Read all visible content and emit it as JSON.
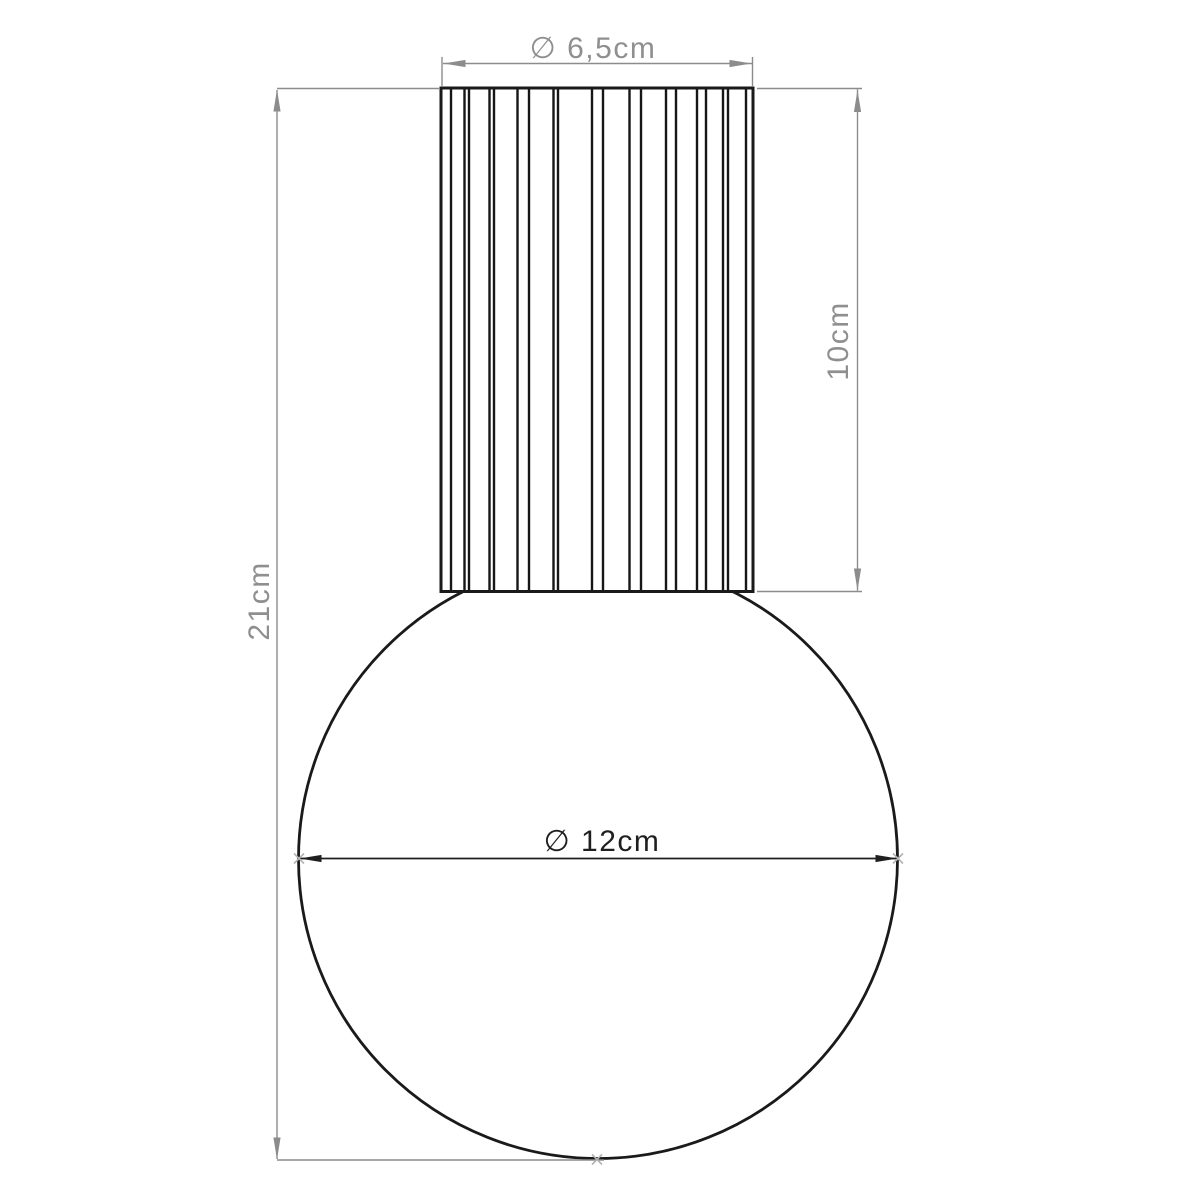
{
  "drawing": {
    "description": "Technical dimension drawing of a ceiling lamp: fluted cylindrical fitting on top of a spherical glass globe",
    "background": "#ffffff"
  },
  "dimensions": {
    "fitting_diameter": {
      "label": "∅ 6,5cm",
      "value_cm": 6.5,
      "orientation": "horizontal",
      "color": "#8f8f8f"
    },
    "fitting_height": {
      "label": "10cm",
      "value_cm": 10,
      "orientation": "vertical",
      "color": "#8f8f8f"
    },
    "total_height": {
      "label": "21cm",
      "value_cm": 21,
      "orientation": "vertical",
      "color": "#8f8f8f"
    },
    "globe_diameter": {
      "label": "∅ 12cm",
      "value_cm": 12,
      "orientation": "horizontal",
      "color": "#1f1f1f"
    }
  },
  "colors": {
    "outline_black": "#1a1a1a",
    "dimension_gray": "#8c8c8c",
    "marker_light_gray": "#b3b3b3",
    "background": "#ffffff"
  }
}
